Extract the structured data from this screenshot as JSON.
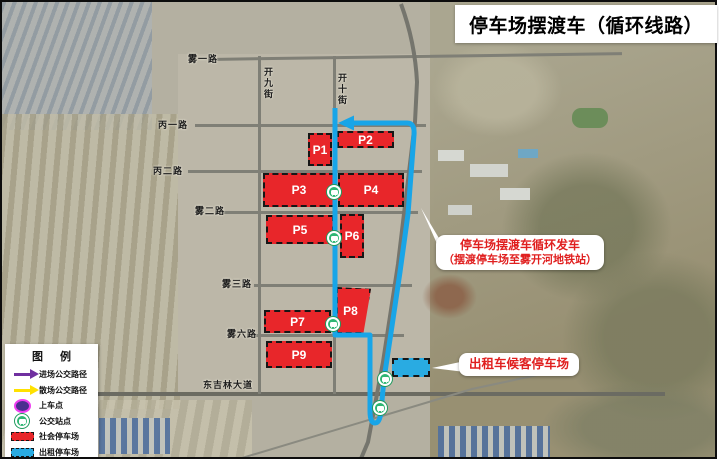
{
  "title": "停车场摆渡车（循环线路）",
  "legend": {
    "title": "图 例",
    "items": [
      {
        "icon": "arrow-purple",
        "label": "进场公交路径"
      },
      {
        "icon": "arrow-yellow",
        "label": "散场公交路径"
      },
      {
        "icon": "boarding-point",
        "label": "上车点"
      },
      {
        "icon": "bus-stop",
        "label": "公交站点"
      },
      {
        "icon": "lot-red",
        "label": "社会停车场"
      },
      {
        "icon": "lot-blue",
        "label": "出租停车场"
      }
    ]
  },
  "map": {
    "road_labels": [
      {
        "text": "雾一路"
      },
      {
        "text": "开九街"
      },
      {
        "text": "开十街"
      },
      {
        "text": "丙一路"
      },
      {
        "text": "丙二路"
      },
      {
        "text": "雾二路"
      },
      {
        "text": "雾三路"
      },
      {
        "text": "雾六路"
      },
      {
        "text": "东吉林大道"
      }
    ],
    "parking_lots": [
      {
        "label": "P1"
      },
      {
        "label": "P2"
      },
      {
        "label": "P3"
      },
      {
        "label": "P4"
      },
      {
        "label": "P5"
      },
      {
        "label": "P6"
      },
      {
        "label": "P7"
      },
      {
        "label": "P8"
      },
      {
        "label": "P9"
      }
    ],
    "annotations": [
      {
        "line1": "停车场摆渡车循环发车",
        "line2": "（摆渡停车场至雾开河地铁站）"
      },
      {
        "line1": "出租车候客停车场"
      }
    ],
    "bus_stop_count": "5"
  },
  "colors": {
    "route_blue": "#18a5e8",
    "parking_red": "#e8262a",
    "taxi_blue": "#29abe2",
    "bus_stop_green": "#2eb673",
    "arrow_purple": "#7030a0",
    "arrow_yellow": "#ffe100",
    "annotation_red": "#e01f1f"
  }
}
